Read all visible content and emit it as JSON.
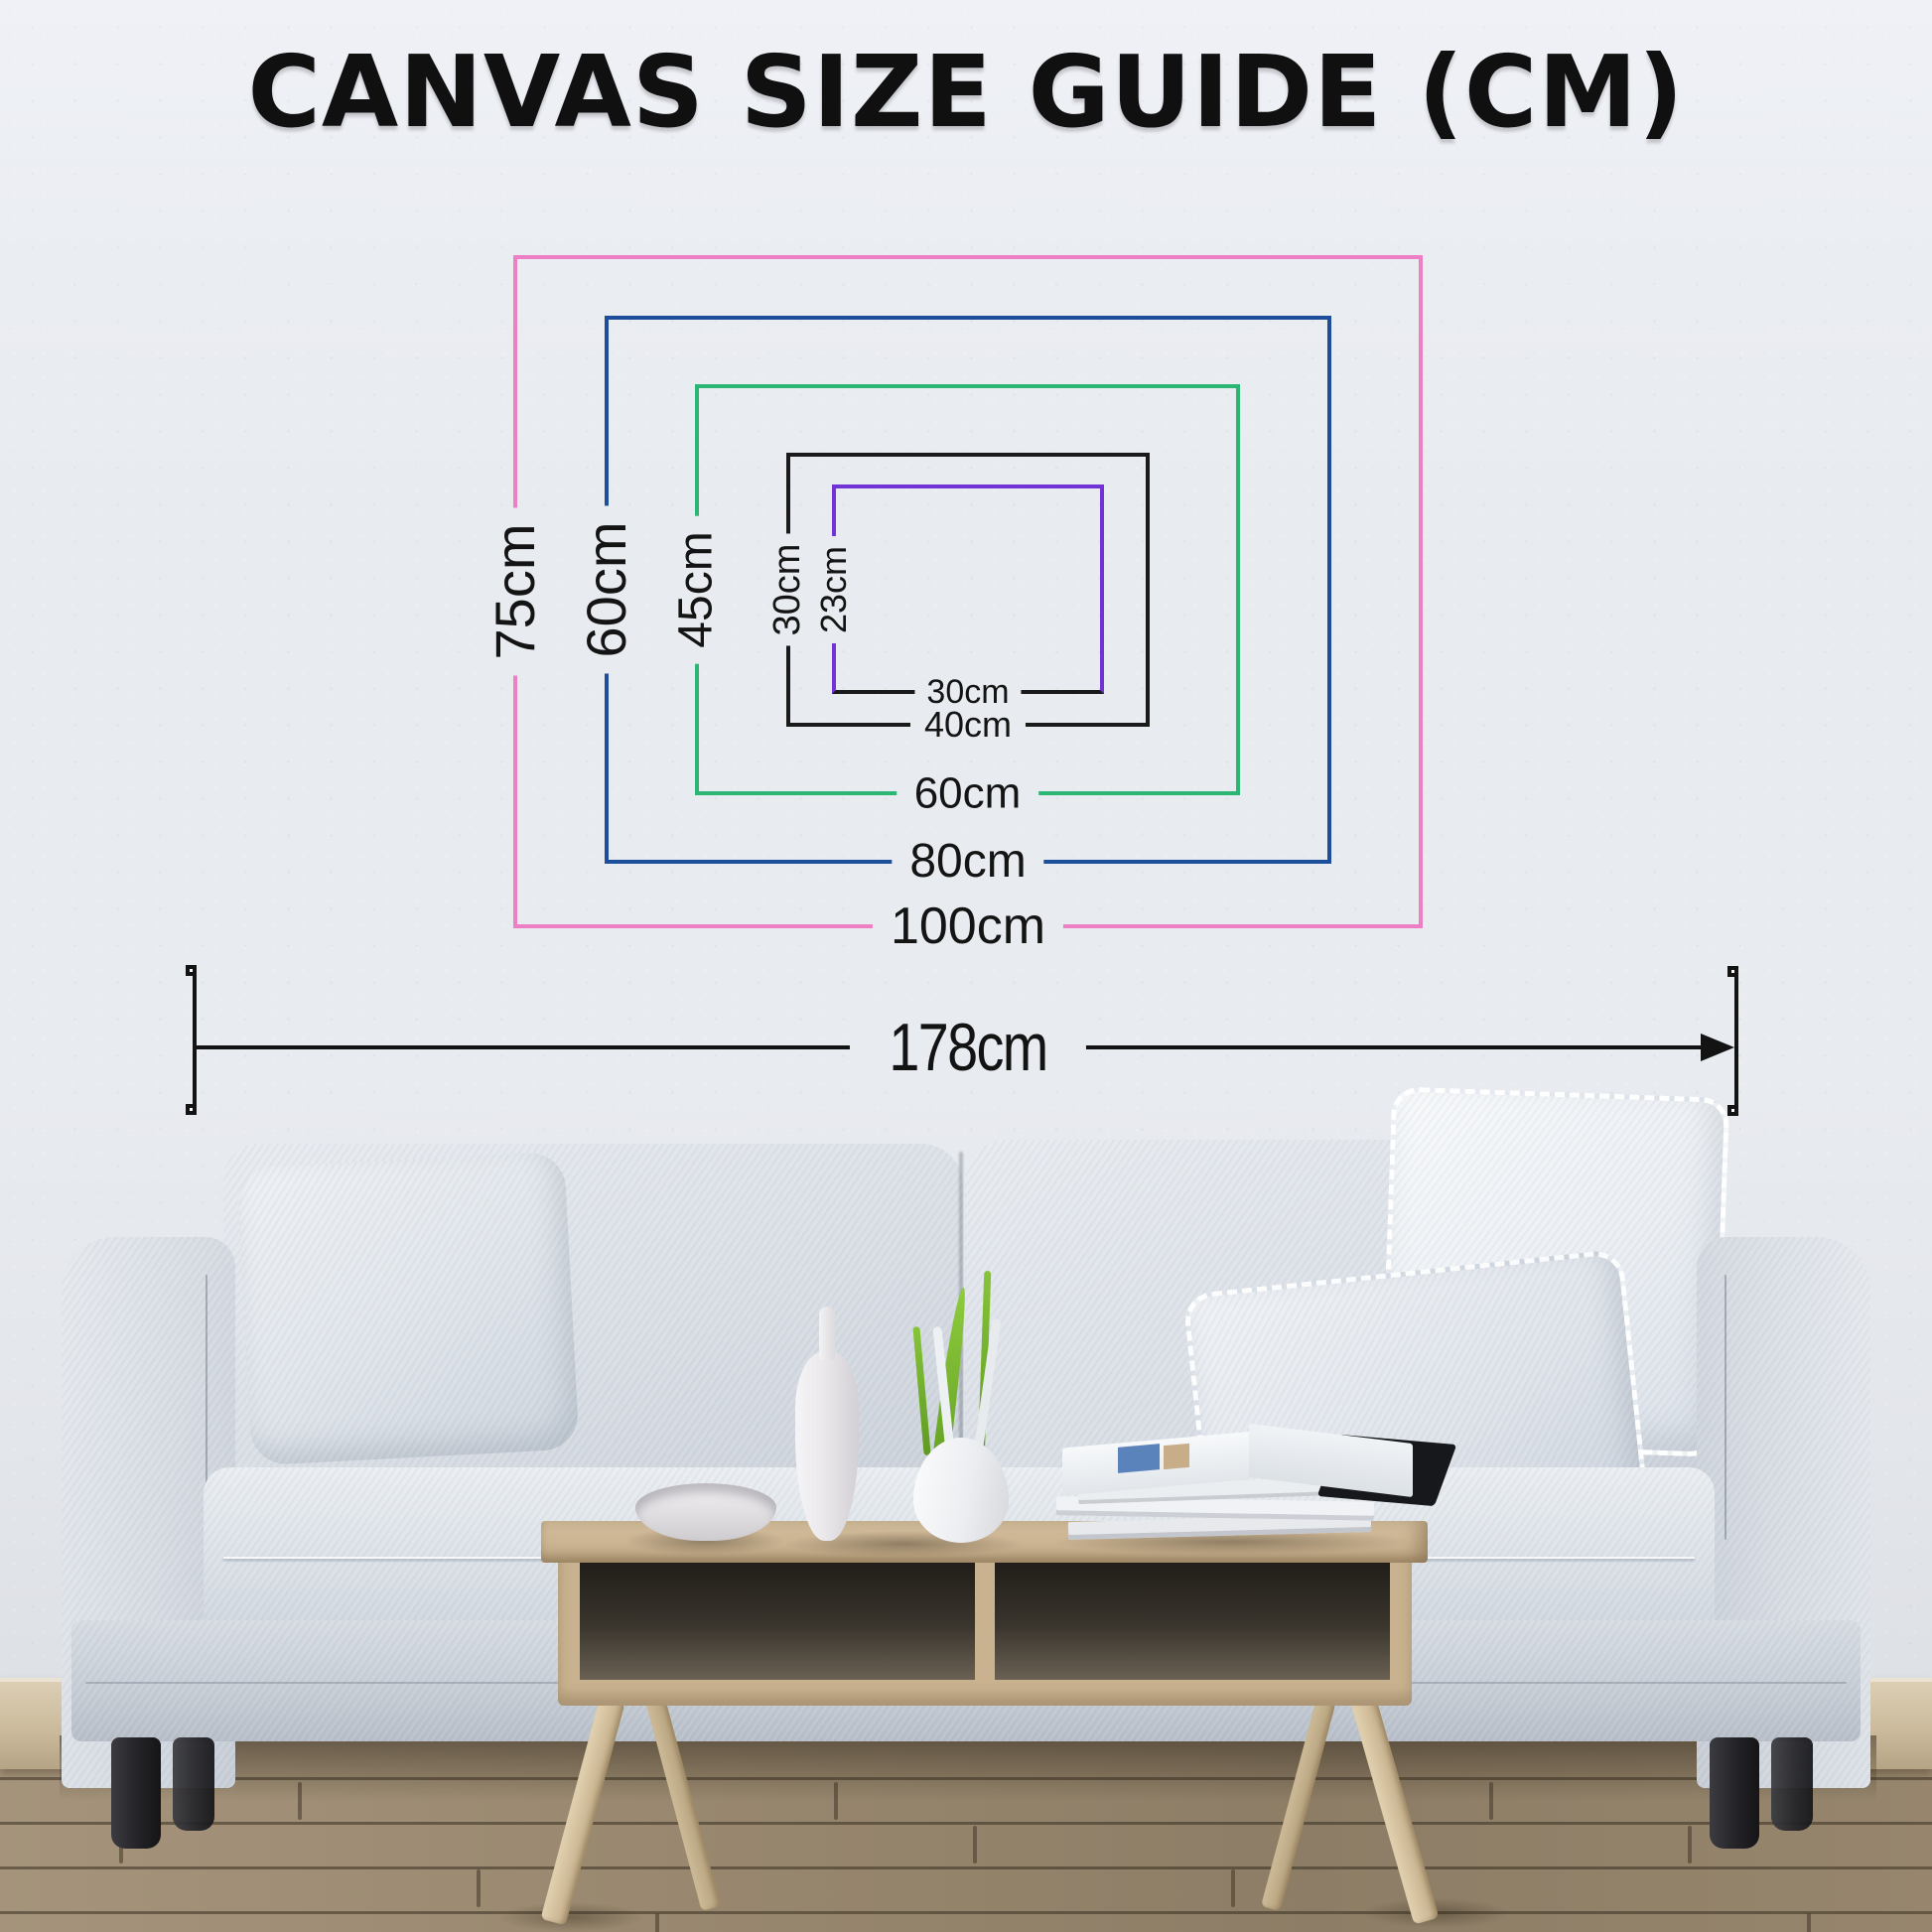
{
  "title": "CANVAS SIZE GUIDE (CM)",
  "canvas_sizes": [
    {
      "name": "100x75cm",
      "width_label": "100cm",
      "height_label": "75cm",
      "width_cm": 100,
      "height_cm": 75,
      "color": "#ee7fc5"
    },
    {
      "name": "80x60cm",
      "width_label": "80cm",
      "height_label": "60cm",
      "width_cm": 80,
      "height_cm": 60,
      "color": "#1d4e99"
    },
    {
      "name": "60x45cm",
      "width_label": "60cm",
      "height_label": "45cm",
      "width_cm": 60,
      "height_cm": 45,
      "color": "#2bb673"
    },
    {
      "name": "40x30cm",
      "width_label": "40cm",
      "height_label": "30cm",
      "width_cm": 40,
      "height_cm": 30,
      "color": "#1a1a1a"
    },
    {
      "name": "30x23cm",
      "width_label": "30cm",
      "height_label": "23cm",
      "width_cm": 30,
      "height_cm": 23,
      "color": "#7133d6"
    }
  ],
  "wall_width": {
    "label": "178cm",
    "value_cm": 178
  },
  "colors": {
    "pink": "#ee7fc5",
    "blue": "#1d4e99",
    "green": "#2bb673",
    "black": "#1a1a1a",
    "purple": "#7133d6",
    "label_text": "#141414",
    "wall": "#e8ebf0",
    "floor": "#99886f"
  }
}
